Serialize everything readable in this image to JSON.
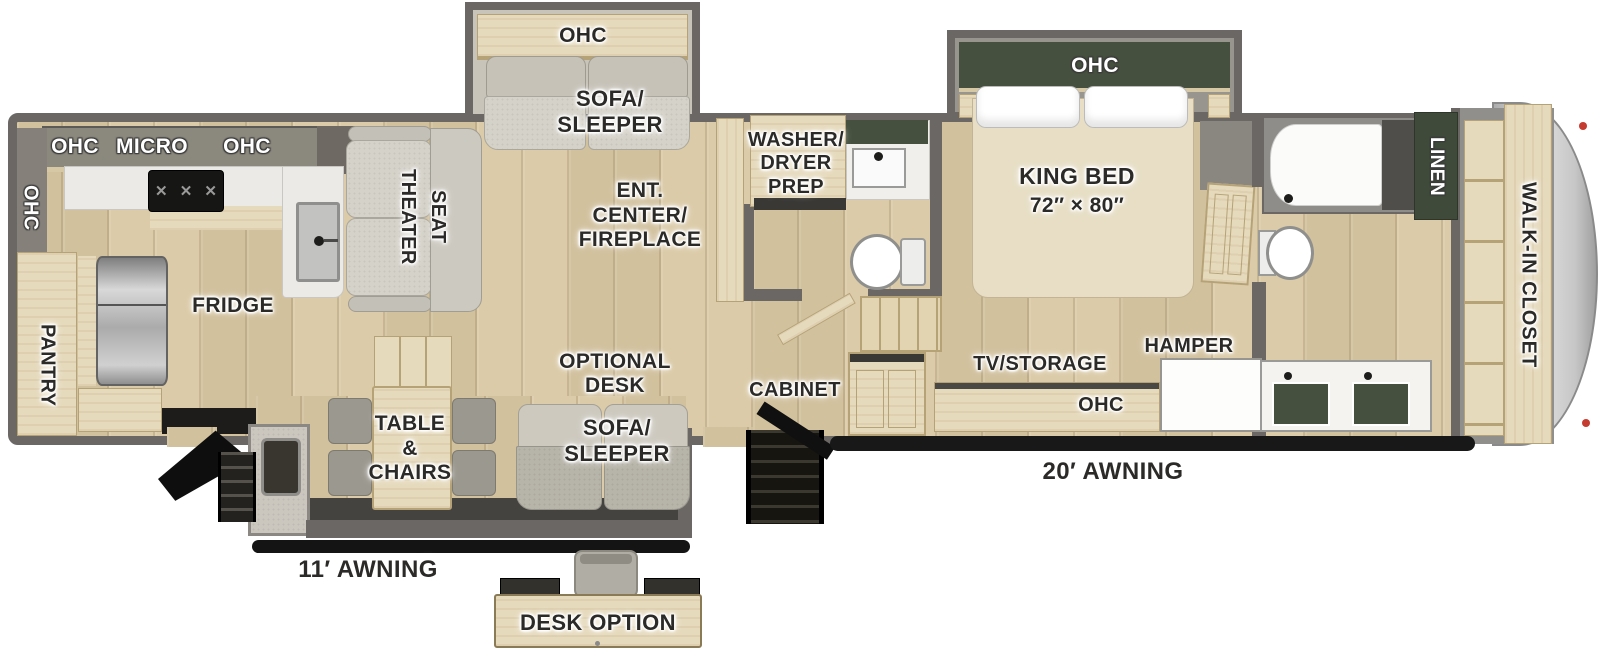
{
  "title": "RV floor plan",
  "colors": {
    "wall_gray": "#6a6765",
    "floor_wood": "#d9c8a3",
    "cabinet_wood": "#e6dabc",
    "dark_green": "#46503e",
    "sofa_fabric": "#d5d2c9",
    "front_cap_gray": "#c9c9c9",
    "awning_black": "#141414",
    "marker_light_red": "#c63b2f",
    "label_dark": "#2b2a28",
    "label_white": "#ffffff"
  },
  "labels": {
    "kitchen": {
      "ohc_wall": "OHC",
      "header_ohc_left": "OHC",
      "header_micro": "MICRO",
      "header_ohc_right": "OHC",
      "pantry": "PANTRY",
      "fridge": "FRIDGE"
    },
    "living": {
      "theater_seat": "THEATER\nSEAT",
      "ent_center": "ENT.\nCENTER/\nFIREPLACE",
      "slide_ohc": "OHC",
      "slide_sofa": "SOFA/\nSLEEPER"
    },
    "mid_bath": {
      "washer_dryer": "WASHER/\nDRYER\nPREP"
    },
    "hall": {
      "cabinet": "CABINET"
    },
    "bedroom": {
      "slide_ohc": "OHC",
      "king_bed": "KING BED",
      "king_bed_size": "72″ × 80″",
      "tv_storage": "TV/STORAGE",
      "hamper": "HAMPER",
      "console_ohc": "OHC"
    },
    "rear_bath": {
      "linen": "LINEN"
    },
    "front": {
      "walk_in_closet": "WALK-IN CLOSET"
    },
    "dinette": {
      "optional_desk": "OPTIONAL\nDESK",
      "sofa_sleeper": "SOFA/\nSLEEPER",
      "table_chairs": "TABLE\n&\nCHAIRS"
    },
    "awnings": {
      "rear": "11′ AWNING",
      "main": "20′ AWNING"
    },
    "inset": {
      "desk_option": "DESK OPTION"
    }
  }
}
